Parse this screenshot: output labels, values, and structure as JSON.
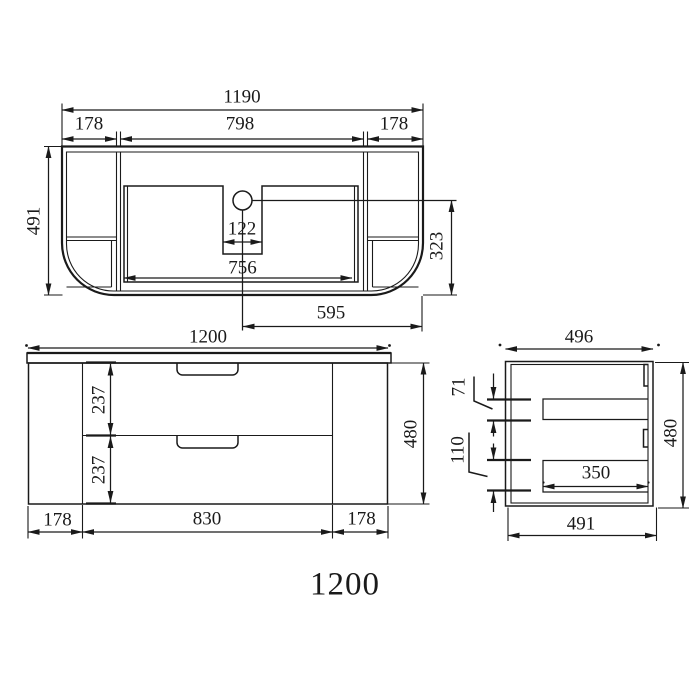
{
  "title": {
    "size_label": "1200"
  },
  "top_view": {
    "dims": {
      "overall_width": "1190",
      "left_panel": "178",
      "center_width": "798",
      "right_panel": "178",
      "depth": "491",
      "hole_width": "122",
      "cutout_width": "756",
      "hole_to_front": "323",
      "hole_to_side": "595"
    }
  },
  "front_view": {
    "dims": {
      "overall_width": "1200",
      "top_drawer_height": "237",
      "bottom_drawer_height": "237",
      "height": "480",
      "left_panel": "178",
      "drawer_width": "830",
      "right_panel": "178"
    }
  },
  "side_view": {
    "dims": {
      "depth": "496",
      "top_rail": "71",
      "bottom_rail": "110",
      "inner_depth": "350",
      "height": "480",
      "bottom_depth": "491"
    }
  }
}
